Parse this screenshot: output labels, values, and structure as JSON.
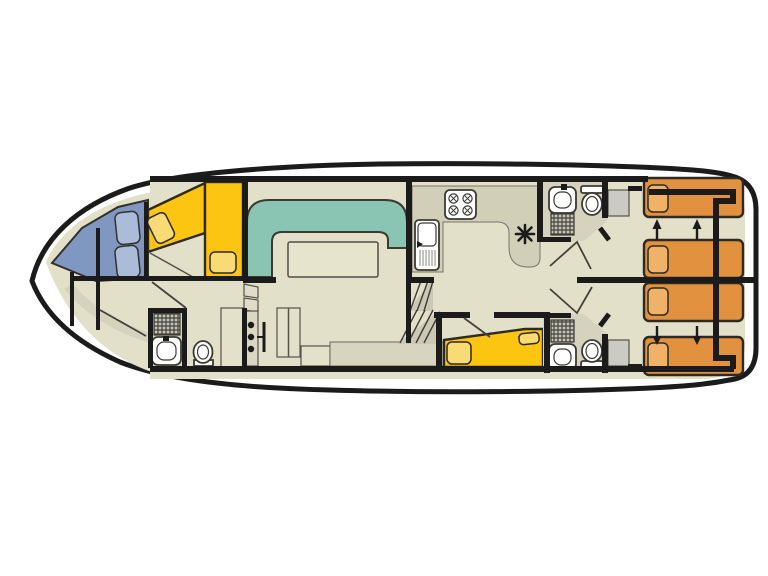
{
  "plan": {
    "type": "boat-deck-floor-plan",
    "orientation": "bow-left-stern-right",
    "colors": {
      "background": "#ffffff",
      "hull_line": "#1b1b1b",
      "floor": "#e3e0ca",
      "floor_dark": "#d5d2bd",
      "settee_teal": "#8ac4b3",
      "bed_yellow": "#fbc511",
      "pillow_yellow": "#f9da74",
      "bow_blue": "#8097c1",
      "cushion_blue": "#abbcd8",
      "bed_orange": "#e2913e",
      "pillow_orange": "#f0b269",
      "locker_gray": "#cbcbc3"
    },
    "rooms": {
      "bow_cabin": {
        "single_beds": 2,
        "pillows": 2
      },
      "bow_seating": {
        "blue_cushions": 2
      },
      "saloon": {
        "settee": "u-shaped",
        "table": 1,
        "benches": 2,
        "cabinets": 3
      },
      "galley": {
        "hob_burners": 4,
        "sink": 1,
        "counter": 1
      },
      "mid_cabin": {
        "double_bed": 1,
        "pillows": 2
      },
      "bathrooms": {
        "count": 3,
        "toilets": 3,
        "washbasins": 3,
        "showers": 3
      },
      "aft_cabins": {
        "count": 2,
        "single_beds": 4,
        "pillows": 4,
        "lockers": 2
      }
    },
    "symbols": {
      "heater_asterisk": 1,
      "slide_arrows_up": 2,
      "slide_arrows_down": 2,
      "drawer_knobs": 3,
      "stair_flights": 2
    }
  }
}
